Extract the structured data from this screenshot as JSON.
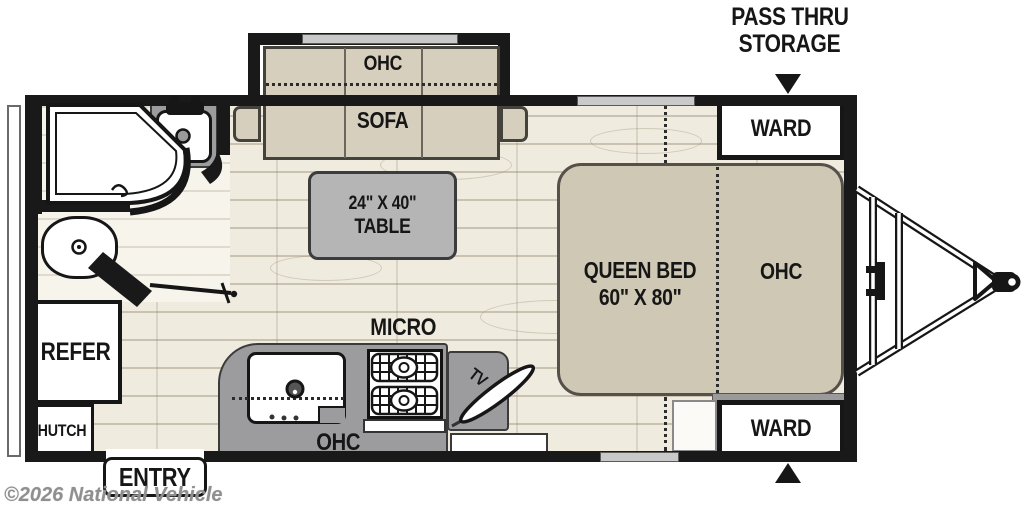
{
  "floorplan": {
    "storage_callout": {
      "line1": "PASS THRU",
      "line2": "STORAGE"
    },
    "bedroom": {
      "ward_top": "WARD",
      "ward_bottom": "WARD",
      "bed_line1": "QUEEN BED",
      "bed_line2": "60\" X 80\"",
      "ohc": "OHC"
    },
    "living": {
      "ohc": "OHC",
      "sofa": "SOFA",
      "table_line1": "24\" X 40\"",
      "table_line2": "TABLE"
    },
    "bath": {
      "shower": "SHOWER"
    },
    "kitchen": {
      "micro": "MICRO",
      "ohc": "OHC",
      "tv": "TV"
    },
    "galley": {
      "refer": "REFER",
      "hutch": "HUTCH"
    },
    "entry": {
      "label": "ENTRY"
    }
  },
  "watermark": {
    "text": "©2026 National Vehicle"
  },
  "colors": {
    "wall": "#191919",
    "sofa_tan": "#d6cfbe",
    "bed_tan": "#cfc8b4",
    "counter_gray": "#9c9c9e",
    "table_gray": "#b5b5b5",
    "floor": "#f0ebdf"
  }
}
